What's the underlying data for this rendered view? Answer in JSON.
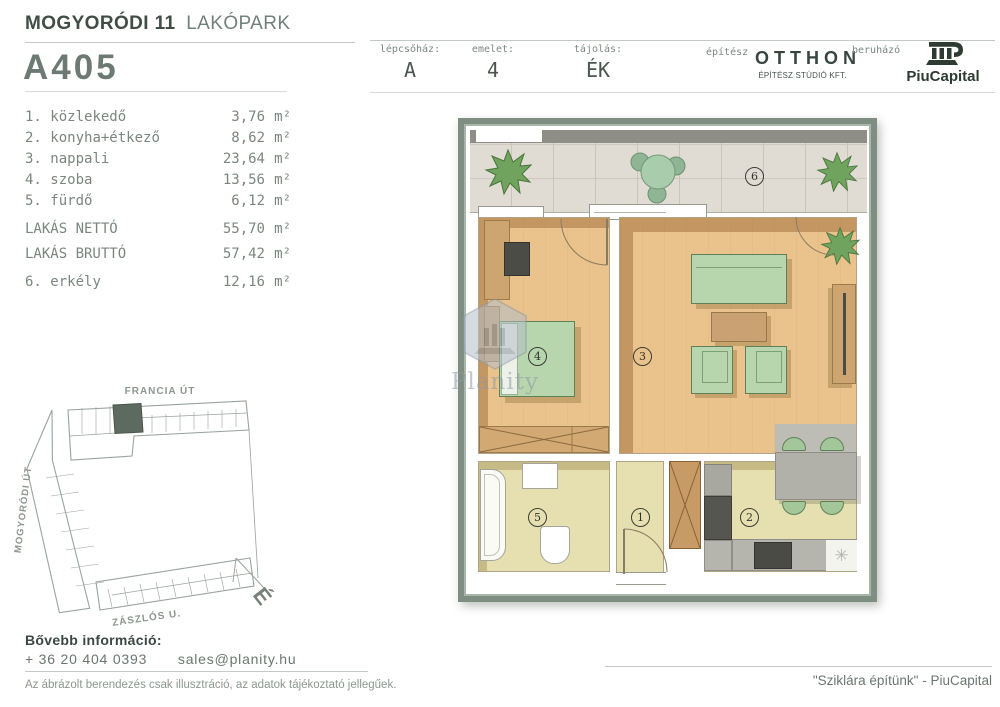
{
  "header": {
    "project_bold": "MOGYORÓDI 11",
    "project_light": "LAKÓPARK",
    "unit_id": "A405"
  },
  "info_bar": {
    "staircase_label": "lépcsőház:",
    "staircase_value": "A",
    "floor_label": "emelet:",
    "floor_value": "4",
    "orientation_label": "tájolás:",
    "orientation_value": "ÉK",
    "architect_label": "építész",
    "architect_name": "OTTHON",
    "architect_sub": "ÉPÍTÉSZ STÚDIÓ KFT.",
    "developer_label": "beruházó",
    "developer_name": "PiuCapital"
  },
  "room_list": {
    "rooms": [
      {
        "num": "1.",
        "name": "közlekedő",
        "area": "3,76",
        "unit": "m²"
      },
      {
        "num": "2.",
        "name": "konyha+étkező",
        "area": "8,62",
        "unit": "m²"
      },
      {
        "num": "3.",
        "name": "nappali",
        "area": "23,64",
        "unit": "m²"
      },
      {
        "num": "4.",
        "name": "szoba",
        "area": "13,56",
        "unit": "m²"
      },
      {
        "num": "5.",
        "name": "fürdő",
        "area": "6,12",
        "unit": "m²"
      }
    ],
    "net_label": "LAKÁS NETTÓ",
    "net_area": "55,70",
    "net_unit": "m²",
    "gross_label": "LAKÁS BRUTTÓ",
    "gross_area": "57,42",
    "gross_unit": "m²",
    "balcony_num": "6.",
    "balcony_name": "erkély",
    "balcony_area": "12,16",
    "balcony_unit": "m²"
  },
  "floor_plan": {
    "labels": {
      "hall": "1",
      "kitchen": "2",
      "living": "3",
      "bedroom": "4",
      "bath": "5",
      "balcony": "6"
    },
    "lamp_symbol": "✳",
    "watermark": "Planity"
  },
  "site_plan": {
    "street_top": "FRANCIA ÚT",
    "street_left": "MOGYORÓDI ÚT",
    "street_bottom": "ZÁSZLÓS U.",
    "north": "É"
  },
  "contact": {
    "heading": "Bővebb információ:",
    "phone": "+ 36 20 404 0393",
    "email": "sales@planity.hu",
    "disclaimer": "Az ábrázolt berendezés csak illusztráció, az adatok tájékoztató jellegűek."
  },
  "footer": {
    "slogan": "\"Sziklára építünk\" - PiuCapital"
  },
  "colors": {
    "accent_dark": "#3e4a43",
    "text_mid": "#6b766f",
    "text_light": "#8b958e",
    "plan_frame": "#7d8d81",
    "wood_floor": "#e9c28c",
    "furniture_green": "#b7d6ae",
    "balcony_tile": "#e0dcd4",
    "wet_floor": "#e6dfb0"
  }
}
